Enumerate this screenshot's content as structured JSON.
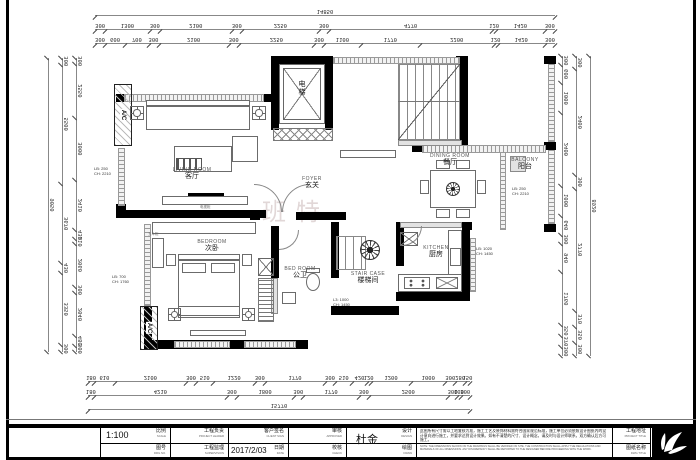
{
  "watermark": "班特",
  "rooms": {
    "living": {
      "en": "LIVING ROOM",
      "zh": "客厅"
    },
    "foyer": {
      "en": "FOYER",
      "zh": "玄关"
    },
    "dining": {
      "en": "DINING ROOM",
      "zh": "餐厅"
    },
    "balcony": {
      "en": "BALCONY",
      "zh": "阳台"
    },
    "kitchen": {
      "en": "KITCHEN",
      "zh": "厨房"
    },
    "stair": {
      "en": "STAIR CASE",
      "zh": "楼梯间"
    },
    "bedroom": {
      "en": "BEDROOM",
      "zh": "次卧"
    },
    "bath": {
      "en": "BED ROOM",
      "zh": "公卫"
    },
    "elevator": {
      "zh": "电梯"
    },
    "ac": {
      "label": "A/C"
    }
  },
  "furniture_labels": {
    "tv": "电视柜",
    "dresser": "五斗柜"
  },
  "annotations": {
    "left_wall": {
      "l1": "LB: 250",
      "l2": "CH: 2210"
    },
    "left_lower": {
      "l1": "LB: 700",
      "l2": "CH: 1760"
    },
    "balcony": {
      "l1": "LB: 250",
      "l2": "CH: 2210"
    },
    "kitchen": {
      "l1": "LB: 1020",
      "l2": "CH: 1450"
    },
    "bath": {
      "l1": "L3: 1000",
      "l2": "CH: 1450"
    }
  },
  "dims": {
    "top_total": [
      "14850"
    ],
    "top2": [
      "300",
      "1300",
      "300",
      "2100",
      "300",
      "2250",
      "300",
      "4770",
      "120",
      "1420",
      "300"
    ],
    "top3": [
      "300",
      "600",
      "700",
      "300",
      "2100",
      "300",
      "2250",
      "300",
      "1100",
      "1770",
      "2200",
      "120",
      "1420",
      "300"
    ],
    "bottom1": [
      "180",
      "610",
      "2100",
      "300",
      "510",
      "1220",
      "300",
      "1770",
      "300",
      "510",
      "420",
      "120",
      "1200",
      "1000",
      "300",
      "280",
      "150"
    ],
    "bottom2": [
      "180",
      "4210",
      "300",
      "1800",
      "300",
      "1770",
      "300",
      "2500",
      "300",
      "100",
      "300"
    ],
    "bottom_total": [
      "15770"
    ],
    "left_inner": [
      "300",
      "2550",
      "3000",
      "2410",
      "430",
      "210",
      "2060",
      "300",
      "2040",
      "480",
      "300"
    ],
    "left_mid": [
      "300",
      "5500",
      "3670",
      "430",
      "3350",
      "300"
    ],
    "left_outer": [
      "9050"
    ],
    "right_inner": [
      "300",
      "600",
      "1000",
      "2400",
      "1000",
      "640",
      "300",
      "940",
      "1760",
      "350",
      "370",
      "300"
    ],
    "right_mid": [
      "300",
      "2400",
      "300",
      "2770",
      "370",
      "350",
      "300"
    ],
    "right_outer": [
      "8920"
    ]
  },
  "titleblock": {
    "scale_label": "比例",
    "scale_sub": "SCALE",
    "scale_value": "1:100",
    "drg_label": "图号",
    "drg_sub": "DRG NO.",
    "leader_label": "工程负责",
    "leader_sub": "PROJECT LEADER",
    "supervision_label": "工程监理",
    "supervision_sub": "SUPERVISION",
    "client_label": "客户签名",
    "client_sub": "CLIENT SIGN",
    "date_label": "日期",
    "date_sub": "DATE",
    "date_value": "2017/2/03",
    "approved_label": "审核",
    "approved_sub": "APPROVED",
    "check_label": "校核",
    "check_sub": "CHECK",
    "design_label": "设计",
    "design_sub": "DESIGN",
    "design_value": "杜金",
    "draw_label": "绘图",
    "draw_sub": "DRAW",
    "addr_label": "工程地址",
    "addr_sub": "PROJECT TITLE",
    "dwg_label": "图纸名称",
    "dwg_sub": "DWG TITLE",
    "notes_cn": "此图所有尺寸需以工地复核为准，施工工艺及装饰材料需符合国家规范标准，施工单位必须依照设计图纸内的设计意向进行施工，并要求达到设计效果。如有不清楚的尺寸、设计概念，请及时与设计师联系，双方确认后方可施工。",
    "notes_en": "NOTE: THE DIMENSIONS SHOWN ON THE DRAWINGS SHALL BE VERIFIED ON SITE. THE CONSTRUCTION SHALL APPLY THE REGULATIONS AND MATERIALS OF ALL DIMENSIONS. ANY DISCREPANCY SHALL BE REPORTED TO THE DESIGNER BEFORE PROCEEDING WITH THE WORK."
  },
  "colors": {
    "wall": "#000000",
    "hatch": "#9a9a9a",
    "line": "#888888",
    "watermark": "#c4b0b0"
  }
}
